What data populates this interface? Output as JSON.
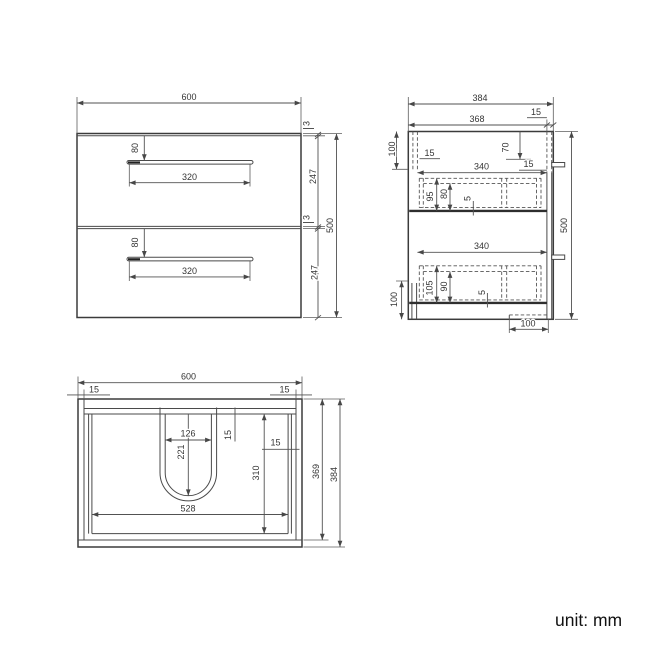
{
  "unit_note": "unit: mm",
  "front_view": {
    "width": "600",
    "top_gap": "3",
    "drawer1_height": "247",
    "mid_gap": "3",
    "drawer2_height": "247",
    "total_height": "500",
    "drawer1_handle_offset": "80",
    "drawer1_handle_length": "320",
    "drawer2_handle_offset": "80",
    "drawer2_handle_length": "320"
  },
  "side_view": {
    "total_depth": "384",
    "inner_depth": "368",
    "back_offset": "15",
    "left_top_height": "100",
    "front_panel_thickness": "15",
    "hanger_drop": "70",
    "hanger_inset": "15",
    "drawer1_inner_depth": "340",
    "drawer1_side_height": "95",
    "drawer1_back_height": "80",
    "drawer1_bottom_thickness": "5",
    "total_height": "500",
    "drawer2_inner_depth": "340",
    "drawer2_side_height": "105",
    "drawer2_back_height": "90",
    "drawer2_bottom_thickness": "5",
    "left_bottom_height": "100",
    "bottom_recess": "100"
  },
  "top_view": {
    "width": "600",
    "left_panel": "15",
    "right_panel": "15",
    "cutout_width": "126",
    "cutout_depth": "221",
    "top_edge_thickness": "15",
    "side_panel_thickness": "15",
    "inner_depth": "310",
    "inner_width": "528",
    "body_depth": "369",
    "total_depth": "384"
  }
}
